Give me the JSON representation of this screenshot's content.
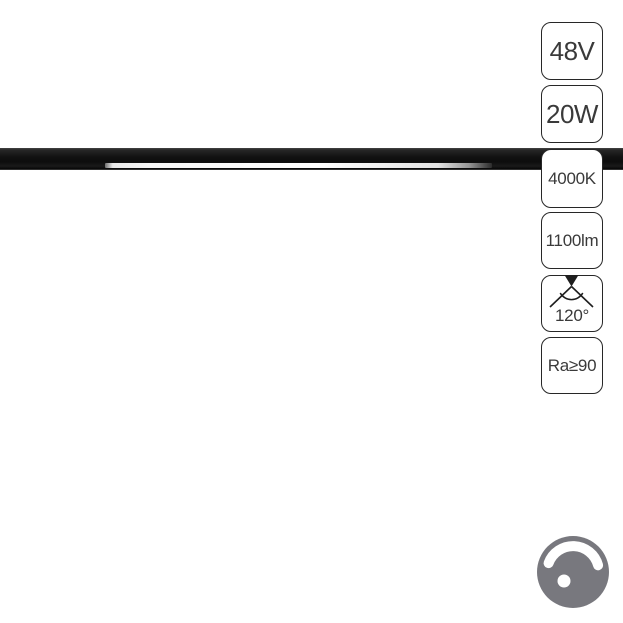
{
  "product_photo": {
    "description": "magnetic track linear LED light on white background",
    "bar_color": "#121212",
    "led_strip_color": "#ffffff"
  },
  "spec_badges": {
    "border_color": "#272727",
    "text_color": "#3a3a3a",
    "voltage": {
      "label": "48V"
    },
    "power": {
      "label": "20W"
    },
    "cct": {
      "label": "4000K"
    },
    "lumen": {
      "label": "1100lm"
    },
    "beam": {
      "label": "120°",
      "icon": "beam-angle-icon"
    },
    "cri": {
      "label": "Ra≥90"
    }
  },
  "dimmer_badge": {
    "icon": "dimmer-knob-icon",
    "meaning": "dimmable",
    "color": "#78787e"
  }
}
